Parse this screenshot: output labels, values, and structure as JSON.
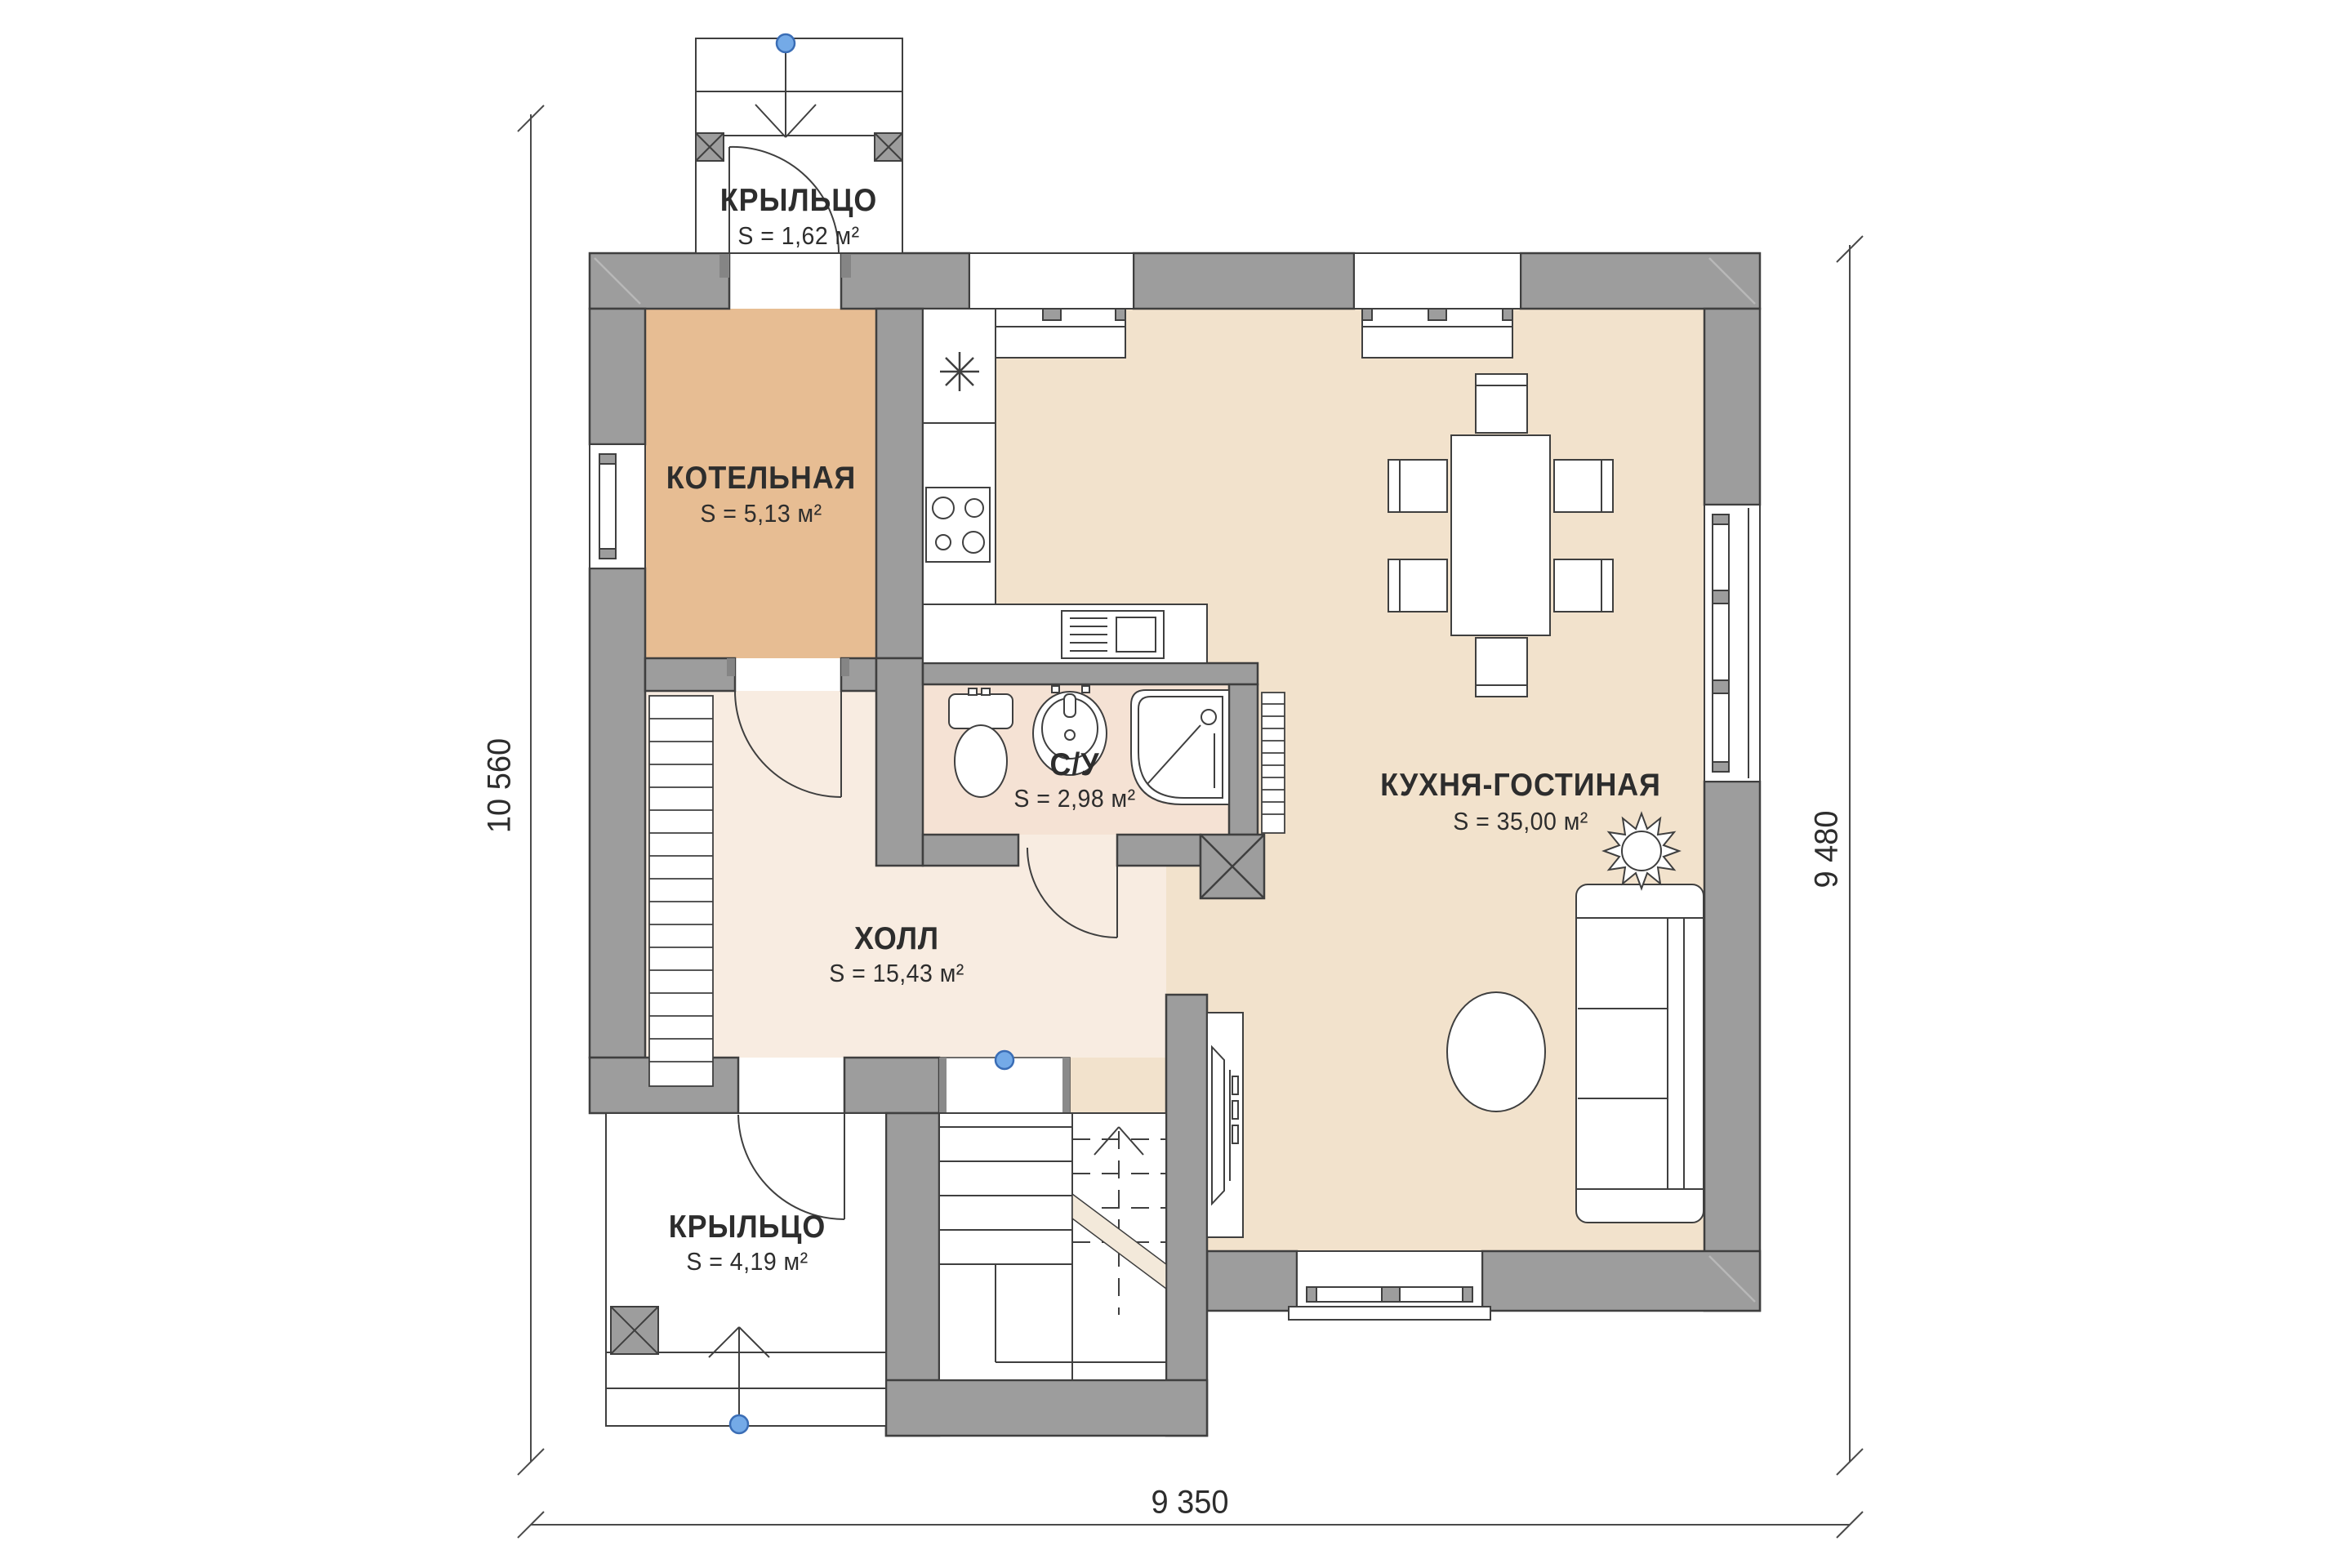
{
  "plan": {
    "type": "architectural floor plan (first floor)",
    "rooms": [
      {
        "id": "porch-top",
        "label": "КРЫЛЬЦО",
        "area": "S = 1,62 м²"
      },
      {
        "id": "boiler-room",
        "label": "КОТЕЛЬНАЯ",
        "area": "S = 5,13 м²"
      },
      {
        "id": "bathroom",
        "label": "С/У",
        "area": "S = 2,98 м²"
      },
      {
        "id": "kitchen-living",
        "label": "КУХНЯ-ГОСТИНАЯ",
        "area": "S = 35,00 м²"
      },
      {
        "id": "hall",
        "label": "ХОЛЛ",
        "area": "S = 15,43 м²"
      },
      {
        "id": "porch-bottom",
        "label": "КРЫЛЬЦО",
        "area": "S = 4,19 м²"
      }
    ],
    "dimensions": {
      "left": "10 560",
      "right": "9 480",
      "bottom": "9 350"
    },
    "icons": [
      "fridge-snowflake-icon",
      "stove-burners-icon",
      "kitchen-sink-icon",
      "toilet-icon",
      "washbasin-icon",
      "shower-icon",
      "radiator-icon",
      "dining-table-icon",
      "chair-icon",
      "sofa-icon",
      "coffee-table-icon",
      "plant-icon",
      "tv-console-icon",
      "stairs-up-icon",
      "entry-point-marker",
      "column-x-marker",
      "door-swing-arc"
    ],
    "colors": {
      "wall_fill": "#9d9d9d",
      "wall_outline": "#3f3f3f",
      "boiler_floor": "#e7bd93",
      "living_floor": "#f2e2cc",
      "hall_floor": "#f8ece1",
      "bath_floor": "#f5e2d4",
      "entry_marker_blue": "#74aae7",
      "line_dark": "#3f3f3f"
    }
  }
}
